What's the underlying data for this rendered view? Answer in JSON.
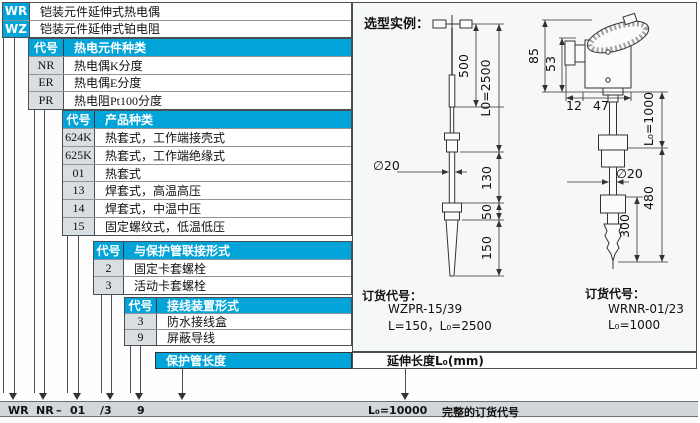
{
  "colors": {
    "accent": "#00a4d8",
    "code_cell_gray": "#d9dee3",
    "bottom_bar_gray": "#d3d7da"
  },
  "table": {
    "top_rows": [
      {
        "code": "WR",
        "desc": "铠装元件延伸式热电偶"
      },
      {
        "code": "WZ",
        "desc": "铠装元件延伸式铂电阻"
      }
    ],
    "sections": [
      {
        "code_header": "代号",
        "title": "热电元件种类",
        "rows": [
          {
            "code": "NR",
            "desc": "热电偶K分度"
          },
          {
            "code": "ER",
            "desc": "热电偶E分度"
          },
          {
            "code": "PR",
            "desc": "热电阻Pt100分度"
          }
        ]
      },
      {
        "code_header": "代号",
        "title": "产品种类",
        "rows": [
          {
            "code": "624K",
            "desc": "热套式，工作端接壳式"
          },
          {
            "code": "625K",
            "desc": "热套式，工作端绝缘式"
          },
          {
            "code": "01",
            "desc": "热套式"
          },
          {
            "code": "13",
            "desc": "焊套式，高温高压"
          },
          {
            "code": "14",
            "desc": "焊套式，中温中压"
          },
          {
            "code": "15",
            "desc": "固定螺纹式，低温低压"
          }
        ]
      },
      {
        "code_header": "代号",
        "title": "与保护管联接形式",
        "rows": [
          {
            "code": "2",
            "desc": "固定卡套螺栓"
          },
          {
            "code": "3",
            "desc": "活动卡套螺栓"
          }
        ]
      },
      {
        "code_header": "代号",
        "title": "接线装置形式",
        "rows": [
          {
            "code": "3",
            "desc": "防水接线盒"
          },
          {
            "code": "9",
            "desc": "屏蔽导线"
          }
        ]
      }
    ],
    "length_header": "保护管长度",
    "extension_header": "延伸长度L₀(mm)"
  },
  "example": {
    "title": "选型实例：",
    "d1": {
      "dims": {
        "len500": "500",
        "l0": "L0=2500",
        "dia": "∅20",
        "len130": "130",
        "len50": "50",
        "len150": "150"
      },
      "order_label": "订货代号：",
      "code": "WZPR-15/39",
      "detail": "L=150，L₀=2500"
    },
    "d2": {
      "dims": {
        "h85": "85",
        "h53": "53",
        "w12": "12",
        "w47": "47",
        "l0": "L₀=1000",
        "dia": "∅20",
        "len480": "480",
        "len300": "300"
      },
      "order_label": "订货代号：",
      "code": "WRNR-01/23",
      "detail": "L₀=1000"
    }
  },
  "footer": {
    "c1": "WR",
    "c2": "NR",
    "c3": "–",
    "c4": "01",
    "c5": "/3",
    "c6": "9",
    "length_code": "L₀=10000",
    "caption": "完整的订货代号"
  }
}
